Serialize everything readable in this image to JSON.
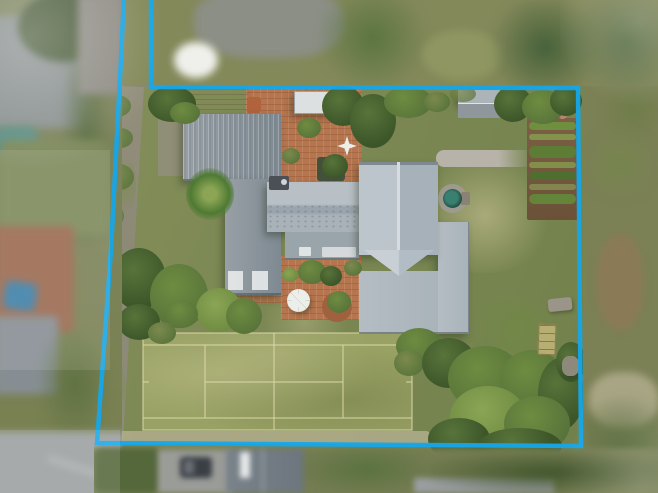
{
  "scene": {
    "type": "aerial-drone-photo",
    "description": "Top-down aerial photo of a residential property outlined by a bright blue boundary line with a battle-axe driveway strip at top-left, a grey-roofed house with brick courtyards, round spa, garden shed, vegetable garden, mature trees and a full-size grass tennis court; neighbouring blurred properties around the edges."
  },
  "boundary": {
    "points_attr": "124,-4 120,78 111,250 97,443 581,446 578,88 151,87 151,-4",
    "stroke_width": 4.5
  },
  "tennis_court": {
    "lines_path": "M143,333 H412 V430 H143 Z M143,345 H412 M143,418 H412 M205,345 V418 M343,345 V418 M274,333 V430 M205,382 H343 M143,382 h6 M406,382 h6",
    "line_width": 1.6
  },
  "colors": {
    "boundary-blue": "#15a6ea",
    "lawn-base": "#87905c",
    "lawn-dark": "#6f7f4a",
    "lawn-light": "#a9aa7a",
    "lawn-pale": "#b9b394",
    "court-grass": "#99a164",
    "court-line": "#ded9ad",
    "tree-dark": "#3c5629",
    "tree-mid": "#58743a",
    "tree-light": "#6f8c41",
    "tree-bright": "#8ba555",
    "tree-olive": "#7c8a4e",
    "palm-green": "#4f7a33",
    "brick": "#b5754e",
    "brick-dark": "#a0613e",
    "tan-wood": "#c4b394",
    "pot-clay": "#b0633c",
    "white-struct": "#dce0e0",
    "garage-a": "#98a0a6",
    "garage-b": "#7e8991",
    "roofc-a": "#b8c0c6",
    "roofc-b": "#9aa4ac",
    "roofc-c": "#a9b2b9",
    "roofr-a": "#bcc5cb",
    "roofr-b": "#a7b1b9",
    "roof-ridge": "#d6dce0",
    "roof-eave": "#7e8992",
    "roofx-a": "#b4bdc3",
    "roofx-b": "#a9b3ba",
    "veranda": "#9aa4ab",
    "chimney": "#4b5056",
    "shed-a": "#adb4b8",
    "shed-b": "#8f979c",
    "path-gray": "#b7b3a8",
    "gravel": "#928e7b",
    "soil": "#7c5f45",
    "soil-dark": "#6b5138",
    "crop-a": "#6f8f3f",
    "crop-b": "#87a14e",
    "crop-c": "#5d7c35",
    "crop-d": "#4f6f30",
    "crop-e": "#8a9a55",
    "crop-f": "#64843a",
    "flower-red": "#b56c63",
    "flower-pink": "#c0836f",
    "spa-rim": "#1e4a41",
    "spa-water": "#3a8070",
    "pad-gray": "#9d9b8e",
    "step-gray": "#8a8274",
    "umbrella-white": "#eceeea",
    "planter-dark": "#43503a",
    "bench-stone": "#9a9588",
    "ladder-wood": "#c9b97e",
    "ladder-line": "#8a7b4a",
    "rock-gray": "#8d8a7c",
    "nb-lawn": "#84895a",
    "nb-gray": "#8b8f85",
    "nb-white": "#eff0ec",
    "nbtree-a": "#5a7540",
    "nbtree-b": "#46613a",
    "nbtree-c": "#52683f",
    "left-base": "#7e8560",
    "left-roof": "#8a9190",
    "left-trees": "#4a5c3a",
    "hedge": "#5d6f45",
    "nb-drive": "#8f8c85",
    "pool-teal": "#5e8f86",
    "nb-lawn2": "#7e8a5c",
    "nb-brick": "#9b6a50",
    "car-blue": "#3e80a8",
    "left-roof2": "#878e93",
    "left-green": "#5f7243",
    "road": "#9b9fa0",
    "curb": "#c9cccb",
    "right-base": "#7b8055",
    "right-brown": "#8a7a55",
    "right-green": "#77854f",
    "right-path": "#a8a584",
    "right-trees": "#4f6534",
    "bottom-base": "#757d52",
    "hedge2": "#55683c",
    "drive2": "#9a9c98",
    "car-dark": "#3a3f45",
    "car-glass": "#6a7077",
    "broof-a": "#79828a",
    "broof-b": "#6d767e",
    "broof-ridge": "#9aa2a8",
    "white": "#e8eaea",
    "hedge3": "#5a7240",
    "road2": "#999da0",
    "btrees": "#43572e"
  }
}
